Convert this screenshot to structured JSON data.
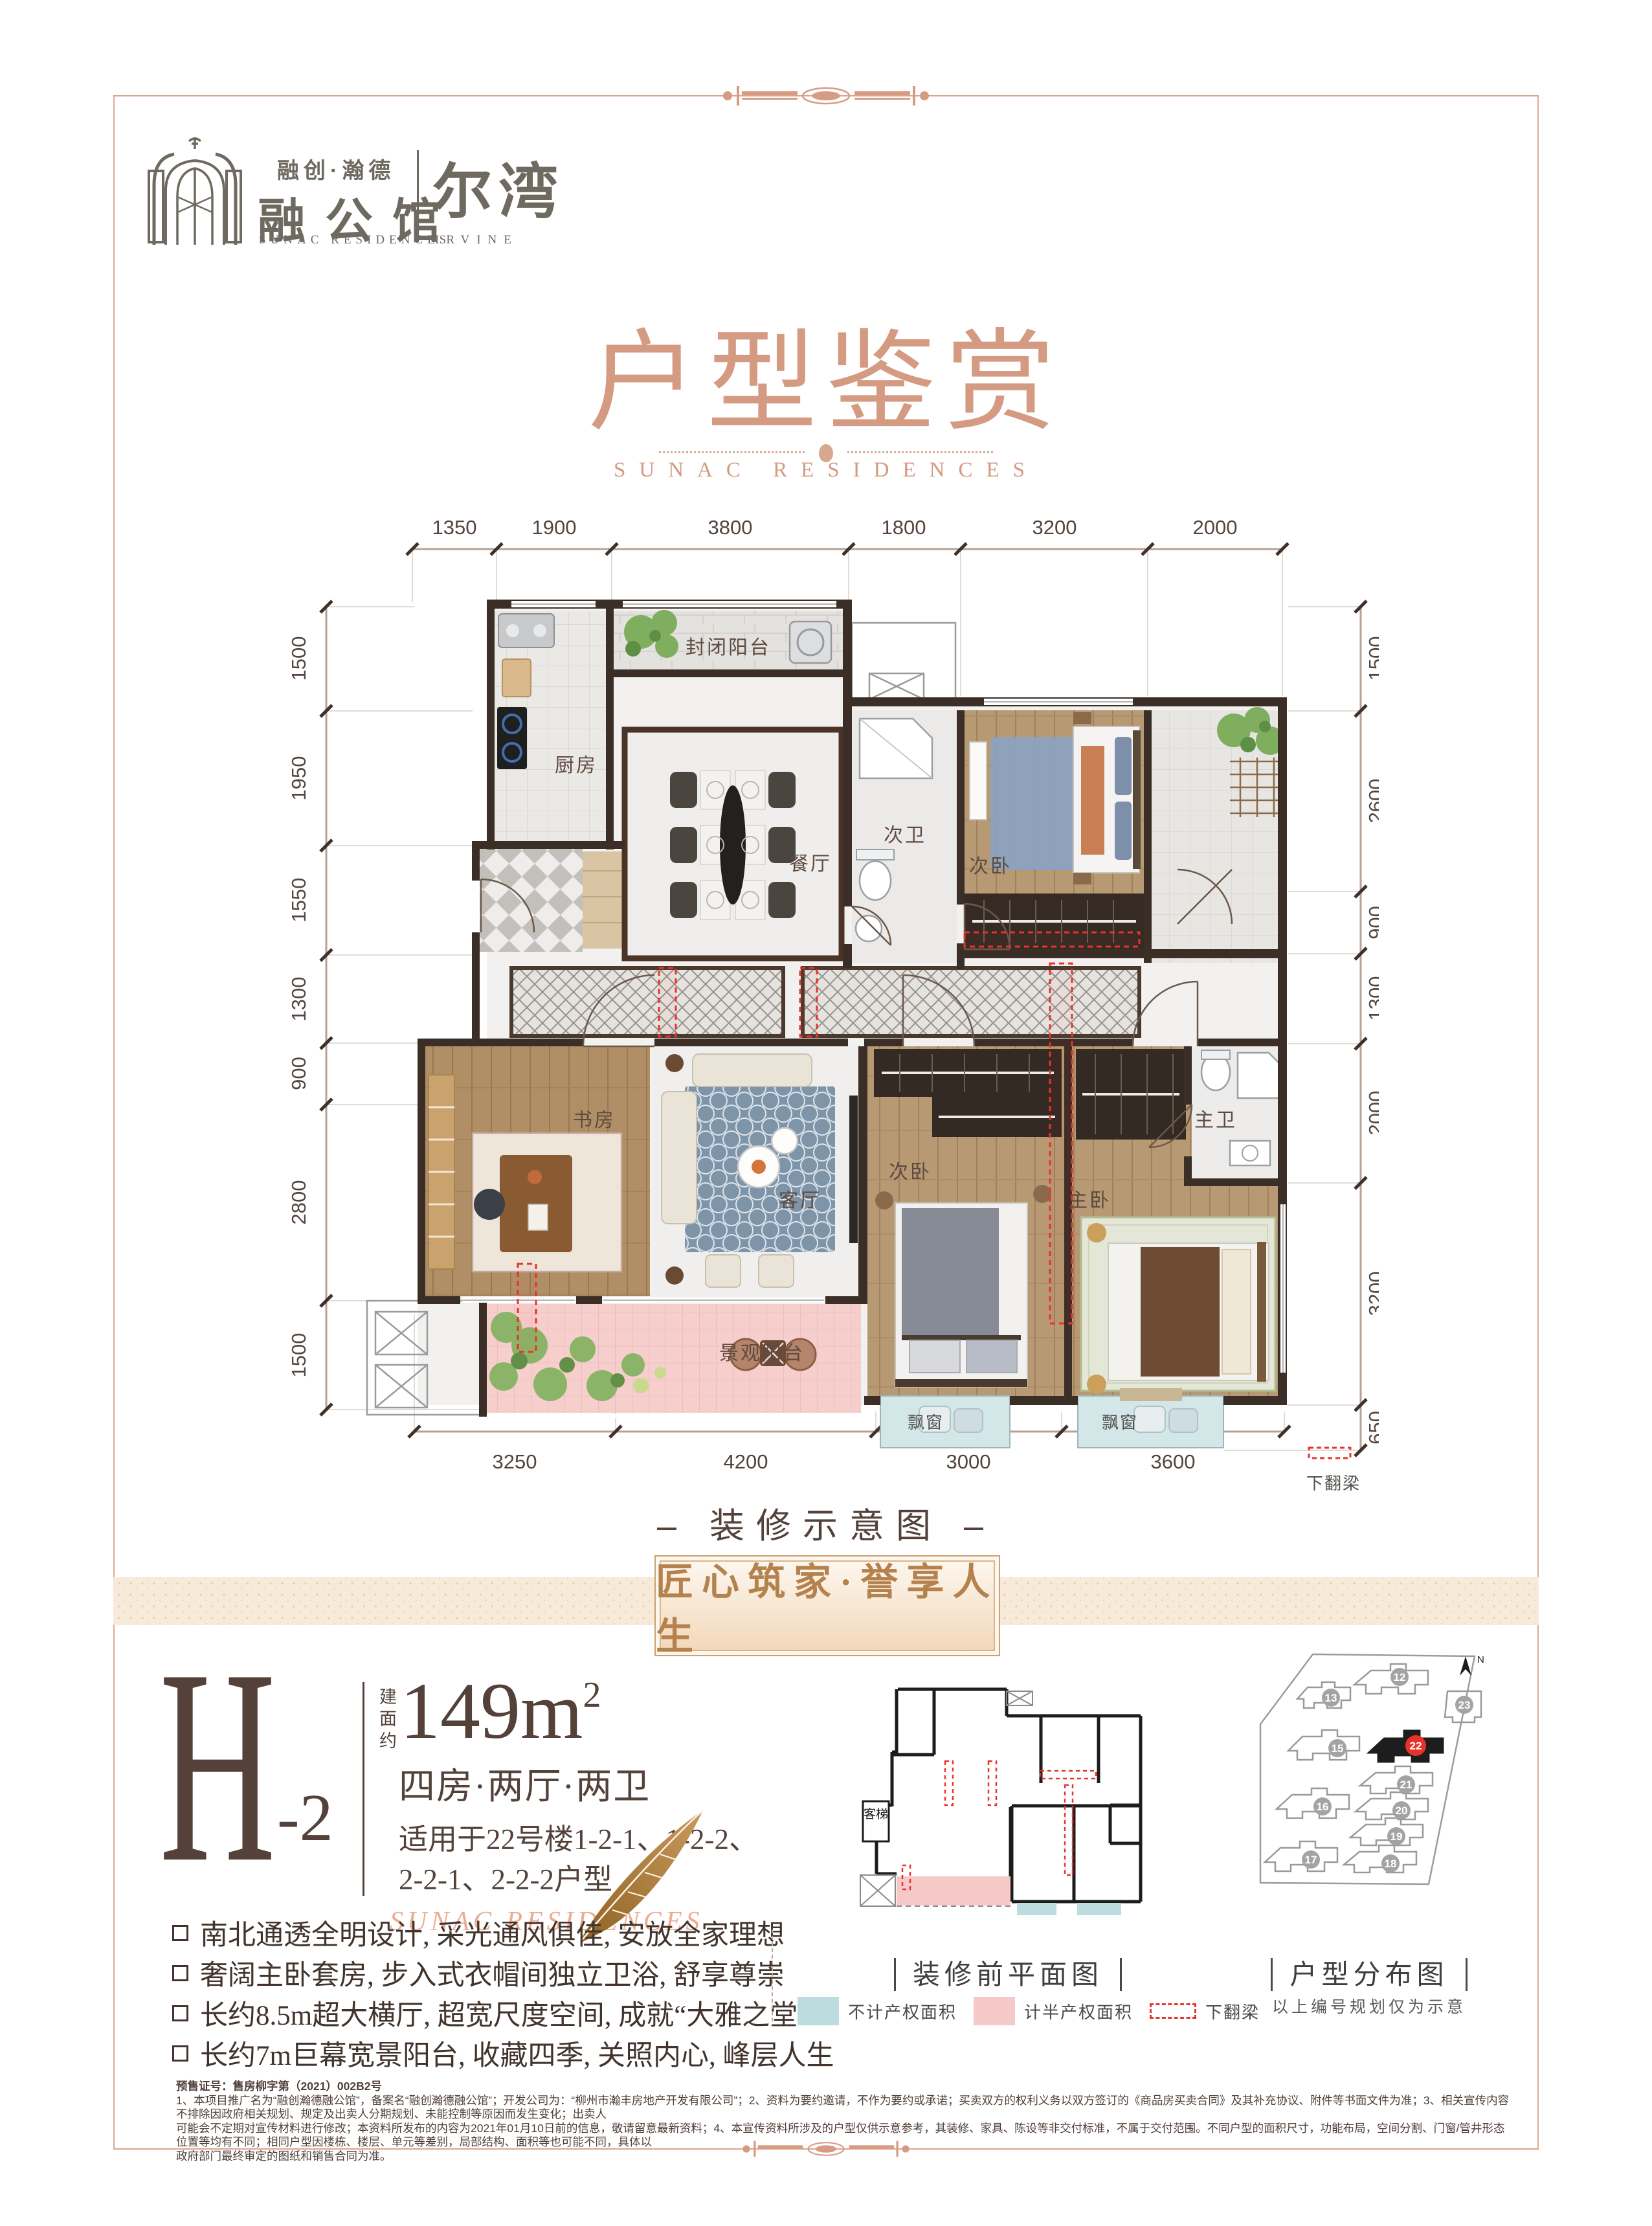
{
  "logo": {
    "brand_cn_small": "融创·瀚德",
    "brand_cn_large": "融公馆",
    "brand_en": "SUNAC RESIDENCES",
    "project_cn": "尔湾",
    "project_en": "IRVINE"
  },
  "title": {
    "main": "户型鉴赏",
    "sub": "SUNAC RESIDENCES"
  },
  "floorplan": {
    "caption": "– 装修示意图 –",
    "beam_label": "下翻梁",
    "rooms": {
      "kitchen": "厨房",
      "enclosed_balcony": "封闭阳台",
      "dining": "餐厅",
      "bath2": "次卫",
      "bedroom2a": "次卧",
      "study": "书房",
      "living": "客厅",
      "bedroom2b": "次卧",
      "master_bedroom": "主卧",
      "master_bath": "主卫",
      "view_balcony": "景观阳台",
      "bay1": "飘窗",
      "bay2": "飘窗"
    },
    "dims": {
      "top": [
        "1350",
        "1900",
        "3800",
        "1800",
        "3200",
        "2000"
      ],
      "left": [
        "1500",
        "1950",
        "1550",
        "1300",
        "900",
        "2800",
        "1500"
      ],
      "right": [
        "1500",
        "2600",
        "900",
        "1300",
        "2000",
        "3200",
        "650"
      ],
      "bottom": [
        "3250",
        "4200",
        "3000",
        "3600"
      ]
    }
  },
  "banner": {
    "text": "匠心筑家·誉享人生"
  },
  "unit": {
    "code": "H",
    "suffix": "-2",
    "area_prefix": "建面约",
    "area_value": "149m",
    "area_sup": "2",
    "layout": "四房·两厅·两卫",
    "apply_line1": "适用于22号楼1-2-1、1-2-2、",
    "apply_line2": "2-2-1、2-2-2户型",
    "script_en": "SUNAC RESIDENCES"
  },
  "features": [
    "南北通透全明设计, 采光通风俱佳, 安放全家理想",
    "奢阔主卧套房, 步入式衣帽间独立卫浴, 舒享尊崇",
    "长约8.5m超大横厅, 超宽尺度空间, 成就“大雅之堂”",
    "长约7m巨幕宽景阳台, 收藏四季, 关照内心, 峰层人生"
  ],
  "pre_plan": {
    "caption": "装修前平面图",
    "elevator": "客梯"
  },
  "legend": {
    "no_property": "不计产权面积",
    "half_property": "计半产权面积",
    "beam": "下翻梁"
  },
  "site_map": {
    "caption": "户型分布图",
    "note": "以上编号规划仅为示意",
    "north": "N",
    "buildings": [
      "12",
      "13",
      "23",
      "15",
      "22",
      "21",
      "16",
      "20",
      "19",
      "17",
      "18"
    ]
  },
  "fine_print": {
    "line0": "预售证号：售房柳字第（2021）002B2号",
    "line1": "1、本项目推广名为“融创瀚德融公馆”，备案名“融创瀚德融公馆”；开发公司为：“柳州市瀚丰房地产开发有限公司”；2、资料为要约邀请，不作为要约或承诺；买卖双方的权利义务以双方签订的《商品房买卖合同》及其补充协议、附件等书面文件为准；3、相关宣传内容不排除因政府相关规划、规定及出卖人分期规划、未能控制等原因而发生变化；出卖人",
    "line2": "可能会不定期对宣传材料进行修改；本资料所发布的内容为2021年01月10日前的信息，敬请留意最新资料；4、本宣传资料所涉及的户型仅供示意参考，其装修、家具、陈设等非交付标准，不属于交付范围。不同户型的面积尺寸，功能布局，空间分割、门窗/管井形态位置等均有不同；相同户型因楼栋、楼层、单元等差别，局部结构、面积等也可能不同，具体以",
    "line3": "政府部门最终审定的图纸和销售合同为准。"
  }
}
